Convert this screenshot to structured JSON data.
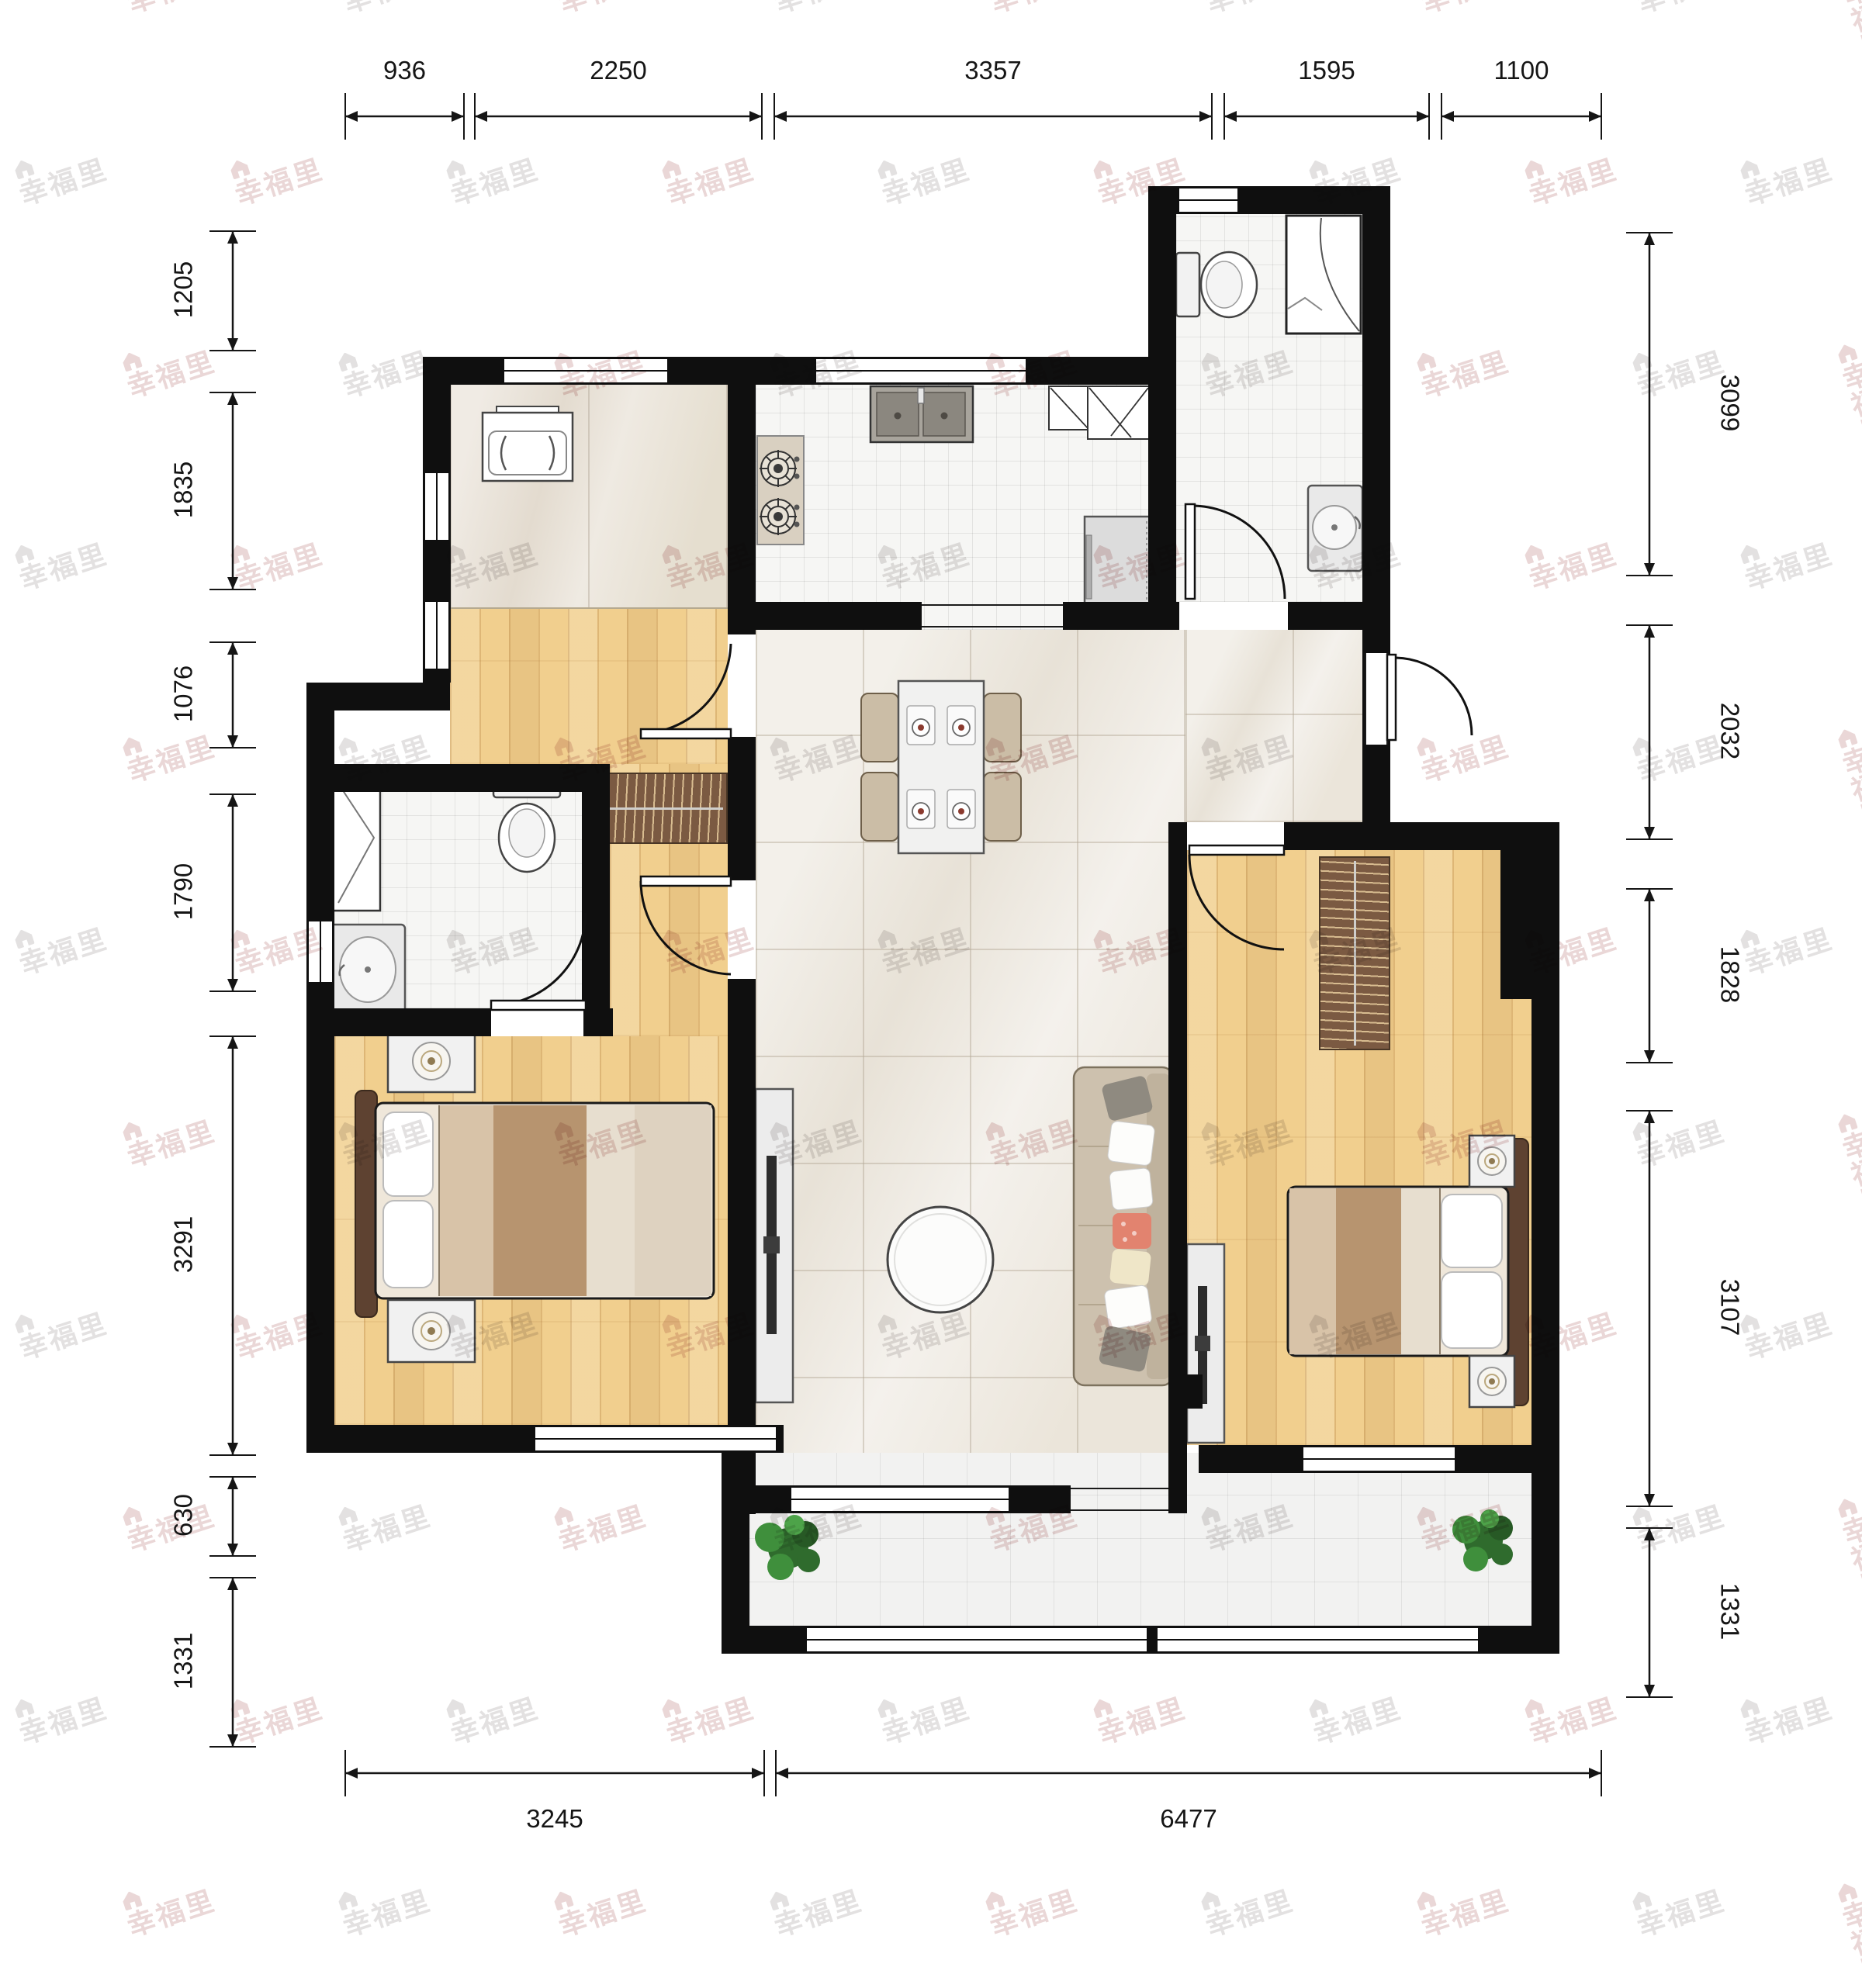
{
  "watermark": {
    "text": "幸福里",
    "logo_icon": "house-logo"
  },
  "dimensions": {
    "top": [
      {
        "label": "936",
        "from": 445,
        "to": 598
      },
      {
        "label": "2250",
        "from": 612,
        "to": 982
      },
      {
        "label": "3357",
        "from": 998,
        "to": 1562
      },
      {
        "label": "1595",
        "from": 1578,
        "to": 1842
      },
      {
        "label": "1100",
        "from": 1858,
        "to": 2064
      }
    ],
    "bottom": [
      {
        "label": "3245",
        "from": 445,
        "to": 985
      },
      {
        "label": "6477",
        "from": 1000,
        "to": 2064
      }
    ],
    "left": [
      {
        "label": "1205",
        "from": 298,
        "to": 452
      },
      {
        "label": "1835",
        "from": 506,
        "to": 760
      },
      {
        "label": "1076",
        "from": 828,
        "to": 964
      },
      {
        "label": "1790",
        "from": 1024,
        "to": 1278
      },
      {
        "label": "3291",
        "from": 1336,
        "to": 1876
      },
      {
        "label": "630",
        "from": 1904,
        "to": 2006
      },
      {
        "label": "1331",
        "from": 2034,
        "to": 2252
      }
    ],
    "right": [
      {
        "label": "3099",
        "from": 300,
        "to": 742
      },
      {
        "label": "2032",
        "from": 806,
        "to": 1082
      },
      {
        "label": "1828",
        "from": 1146,
        "to": 1370
      },
      {
        "label": "3107",
        "from": 1432,
        "to": 1942
      },
      {
        "label": "1331",
        "from": 1970,
        "to": 2188
      }
    ]
  },
  "palette": {
    "wall": "#0f0f0f",
    "wood_floor": "#f1cf8e",
    "marble_floor": "#f1eee8",
    "tile_floor": "#f6f6f4",
    "wardrobe": "#7b5a42",
    "blanket": "#b7946f",
    "sofa": "#cdc1ae",
    "plant": "#2f6b2d",
    "watermark_pink": "#c99797",
    "watermark_gray": "#b5b1b1"
  },
  "icons": {
    "watermark_logo": "house-logo",
    "furniture": [
      "washing-machine",
      "gas-stove",
      "kitchen-sink",
      "corner-cabinet",
      "refrigerator",
      "toilet",
      "shower",
      "bathroom-sink",
      "dining-table",
      "dining-chair",
      "wardrobe",
      "double-bed",
      "nightstand",
      "table-lamp",
      "tv-stand",
      "sofa",
      "coffee-table",
      "plant"
    ]
  }
}
